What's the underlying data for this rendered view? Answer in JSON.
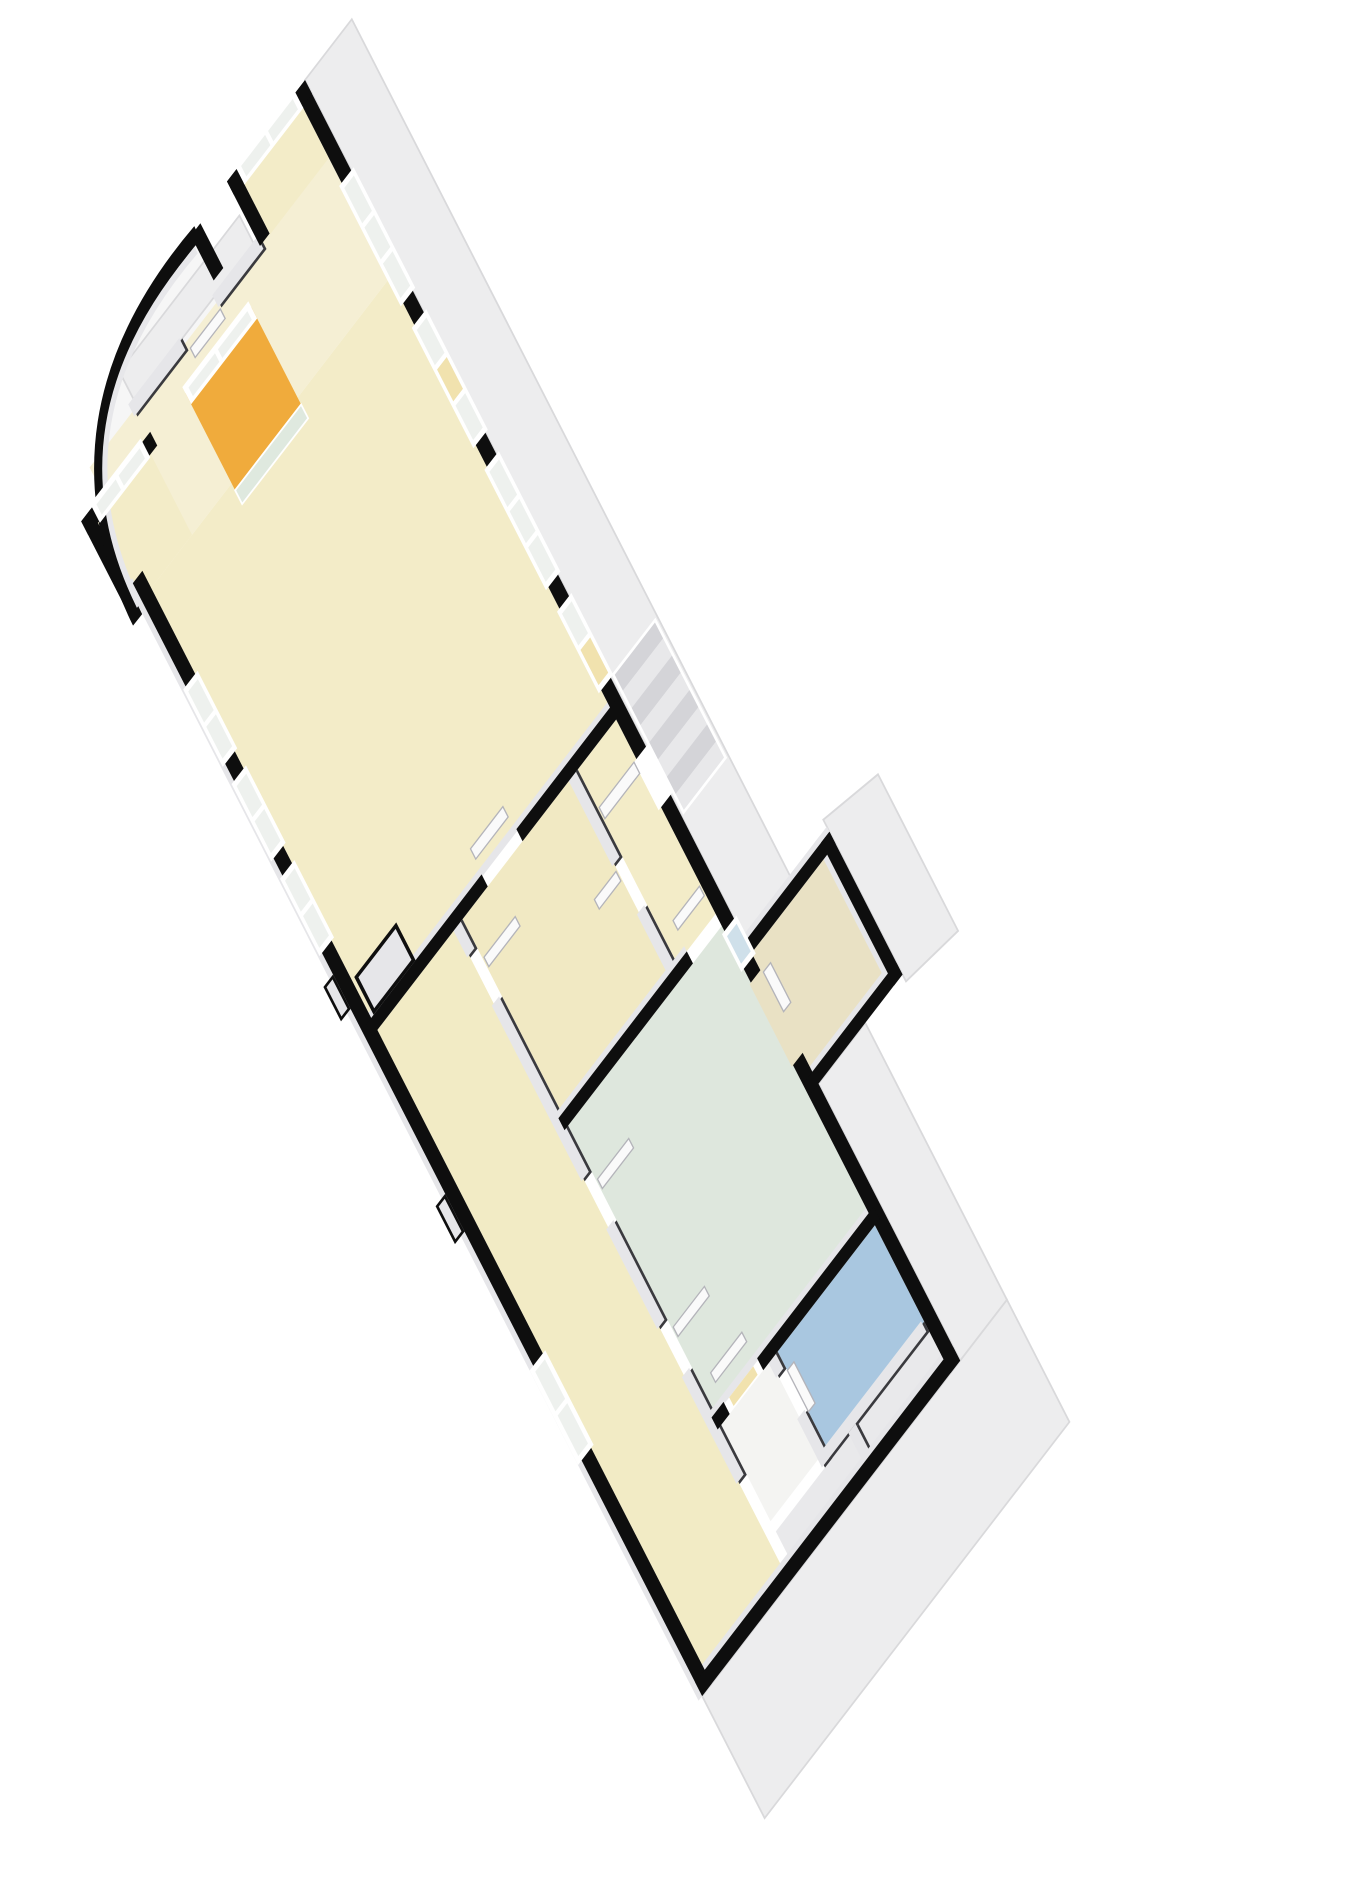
{
  "scene": {
    "kind": "3d-floorplan-axonometric",
    "background": "#ffffff"
  },
  "palette": {
    "exterior_wall": "#0e0e0e",
    "interior_wall_dark": "#3a3a3e",
    "wall_top": "#e6e6e9",
    "envelope": "#ededee",
    "envelope_edge": "#d9d9db",
    "window_frame": "#ffffff",
    "glass": "#eef1ee",
    "glass_amber": "#f1e2ae",
    "glass_blue": "#cfe0ea",
    "door": "#fafafa",
    "stair_stripe_dark": "#d4d4d8",
    "stair_stripe_light": "#e8e8ea"
  },
  "rooms": {
    "living": {
      "color": "#f3ecc8"
    },
    "entry": {
      "color": "#f5efd4"
    },
    "kitchen": {
      "color": "#f0ab3c"
    },
    "corridor": {
      "color": "#f2ebc5"
    },
    "bedroom": {
      "color": "#f1e9c3"
    },
    "hall": {
      "color": "#f3ecc8"
    },
    "green": {
      "color": "#dee7dd"
    },
    "bay": {
      "color": "#e9e1c4"
    },
    "bath": {
      "color": "#a9c7e0"
    },
    "storage": {
      "color": "#f4f4f2"
    },
    "cell": {
      "color": "#e9e9eb"
    },
    "alcove_a": {
      "color": "#f3ecc8"
    },
    "alcove_b": {
      "color": "#f3ecc8"
    },
    "terrace": {
      "color": "#f6f6f6"
    }
  }
}
